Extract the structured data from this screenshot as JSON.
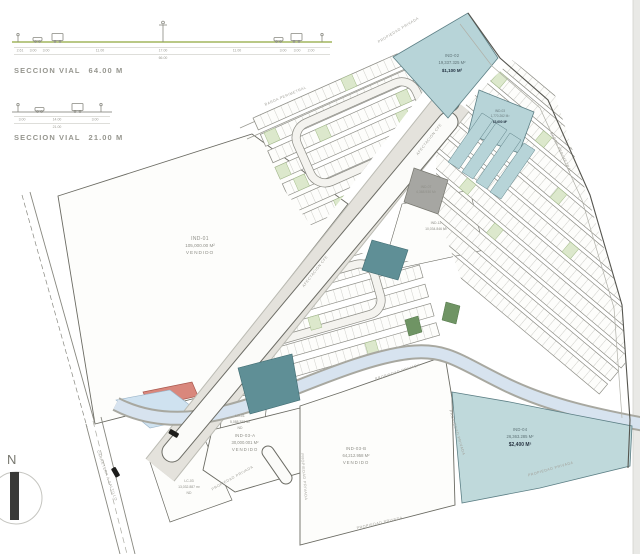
{
  "sections": {
    "s64": {
      "title": "SECCION VIAL",
      "meas": "64.00 M",
      "dims": [
        "2.61",
        "3.00",
        "3.00",
        "11.00",
        "17.00",
        "11.00",
        "3.00",
        "3.00",
        "2.00"
      ],
      "total": "66.00"
    },
    "s21": {
      "title": "SECCION VIAL",
      "meas": "21.00 M",
      "dims": [
        "3.00",
        "14.00",
        "3.00"
      ],
      "total": "21.00"
    }
  },
  "compass": {
    "n": "N"
  },
  "parcels": {
    "ind02": {
      "id": "IND-02",
      "area": "19,337.325 M²",
      "price": "$1,100 M²"
    },
    "ind03": {
      "id": "IND-03",
      "area": "1,770.262 M²",
      "price": "$3,600 M²"
    },
    "ind07": {
      "id": "IND-07",
      "area": "4,368.930 M²"
    },
    "ind12": {
      "id": "IND-12",
      "area": "10,034.846 M²"
    },
    "ind01": {
      "id": "IND-01",
      "area": "105,000.00 M²",
      "status": "VENDIDO"
    },
    "ind03a": {
      "id": "IND-03-A",
      "area": "30,000.001 M²",
      "status": "VENDIDO"
    },
    "ind03b": {
      "id": "IND-03-B",
      "area": "64,212.958 M²",
      "status": "VENDIDO"
    },
    "ind04": {
      "id": "IND-04",
      "area": "26,363.285 M²",
      "price": "$2,400 M²"
    },
    "lo01": {
      "id": "LO-01",
      "area": "5,088.353 M²",
      "note": "ND"
    },
    "lc03": {
      "id": "LC-03",
      "area": "13,032.887 m²",
      "note": "ND"
    }
  },
  "streets": {
    "barda_top": "BARDA PERIMETRAL",
    "barda_right": "BARDA PERIMETRAL",
    "afectacion1": "AFECTACION CFE",
    "afectacion2": "AFECTACION CFE",
    "prop_top": "PROPIEDAD PRIVADA",
    "prop_03a": "PROPIEDAD PRIVADA",
    "prop_03b_left": "PROPIEDAD PRIVADA",
    "prop_03b_top": "PROPIEDAD PRIVADA",
    "prop_bottom": "PROPIEDAD PRIVADA",
    "prop_04_left": "PROPIEDAD PRIVADA",
    "prop_04_right": "PROPIEDAD PRIVADA",
    "carretera": "CARRETERA A SALTILLO"
  },
  "colors": {
    "teal": "#b7d4d8",
    "teal_dark": "#5f8f96",
    "green_lot": "#dce8cc",
    "green_dark": "#6f9464",
    "gray_parcel": "#a6a6a2",
    "red_parcel": "#d9877c",
    "canal": "#d7e3ef",
    "ground_green": "#8fa83f"
  }
}
